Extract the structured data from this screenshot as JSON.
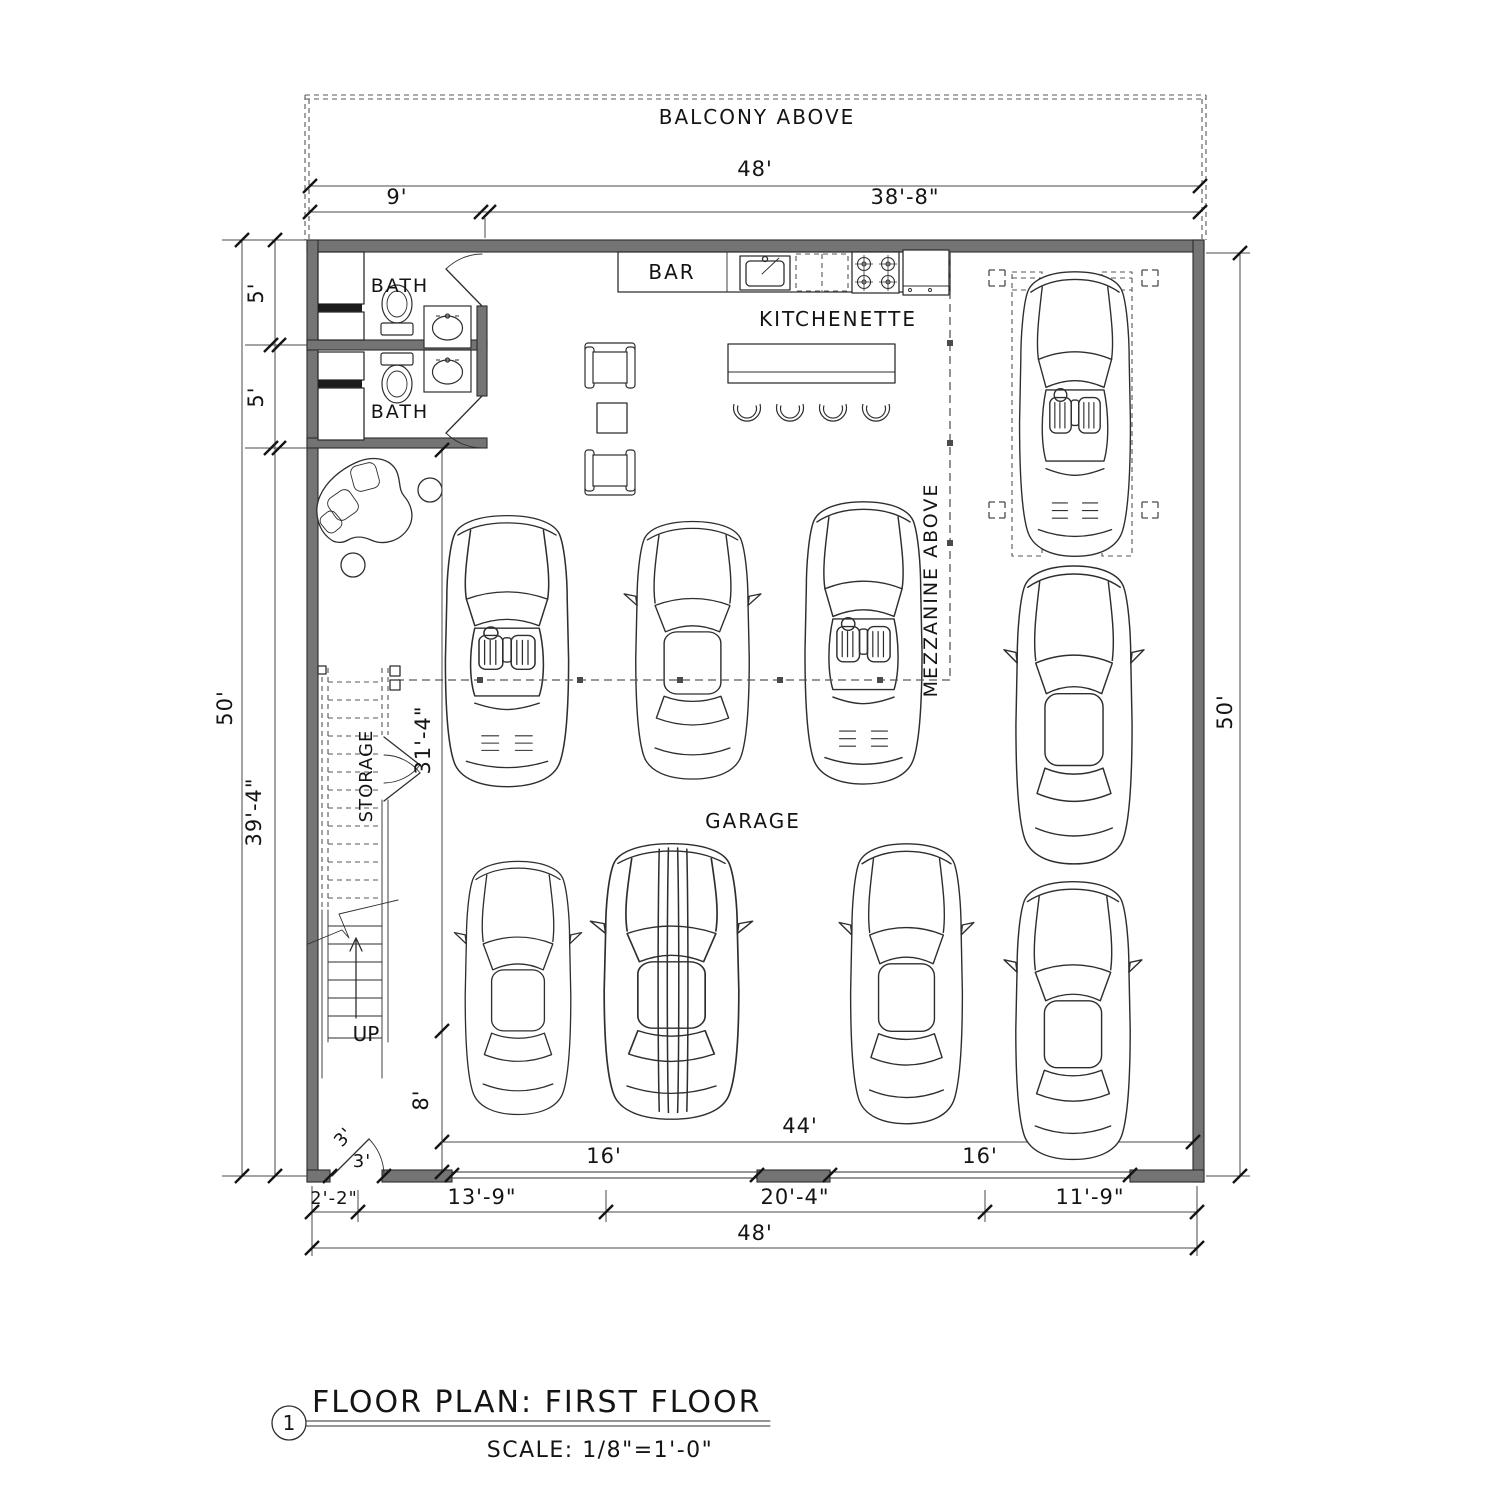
{
  "drawing": {
    "type": "architectural floor plan",
    "line_color": "#2e2e2e",
    "wall_color": "#747474",
    "background": "#ffffff"
  },
  "labels": {
    "balcony": "BALCONY ABOVE",
    "bar": "BAR",
    "kitchenette": "KITCHENETTE",
    "bath_upper": "BATH",
    "bath_lower": "BATH",
    "mezzanine": "MEZZANINE ABOVE",
    "garage": "GARAGE",
    "storage": "STORAGE",
    "up": "UP"
  },
  "dims": {
    "top_overall": "48'",
    "top_left": "9'",
    "top_right": "38'-8\"",
    "left_overall": "50'",
    "left_upper": "5'",
    "left_mid": "5'",
    "left_lower": "39'-4\"",
    "right_overall": "50'",
    "interior_vertical": "31'-4\"",
    "stair_bay": "8'",
    "entry_swing": "3'",
    "entry_width": "3'",
    "garage_interior": "44'",
    "garage_door_left": "16'",
    "garage_door_right": "16'",
    "bottom_seg1": "2'-2\"",
    "bottom_seg2": "13'-9\"",
    "bottom_seg3": "20'-4\"",
    "bottom_seg4": "11'-9\"",
    "bottom_overall": "48'"
  },
  "titleblock": {
    "number": "1",
    "title": "FLOOR PLAN: FIRST FLOOR",
    "scale": "SCALE: 1/8\"=1'-0\""
  }
}
